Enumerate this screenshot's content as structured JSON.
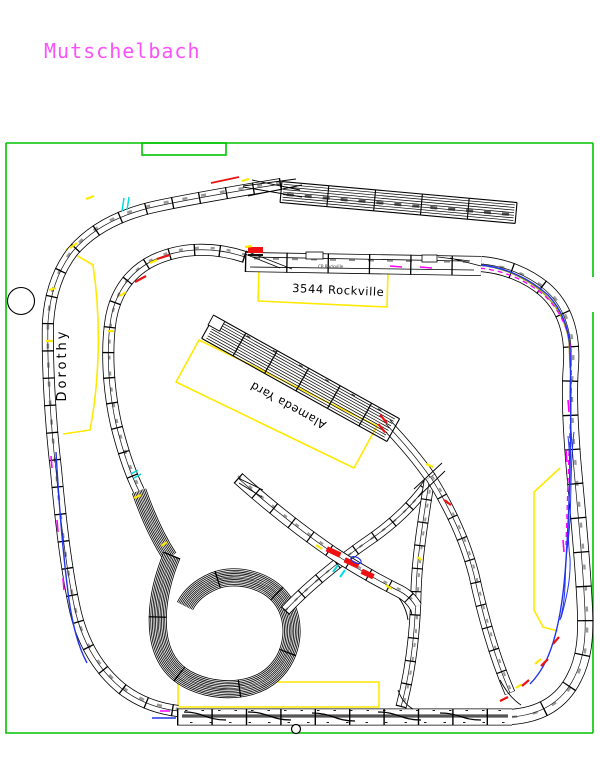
{
  "title": "Mutschelbach",
  "labels": {
    "dorothy": "Dorothy",
    "rockville_station": "3544 Rockville",
    "alameda_yard": "Alameda Yard",
    "cp_rockville": "CP Rockville"
  },
  "palette": {
    "room_outline": "#00c400",
    "region_outline": "#ffe900",
    "title_text": "#fb52fb",
    "track_line": "#000000",
    "accent_red": "#ee1111",
    "accent_blue": "#2233ee",
    "accent_magenta": "#ff00ff",
    "accent_cyan": "#00dddd",
    "accent_olive": "#a0a000"
  }
}
